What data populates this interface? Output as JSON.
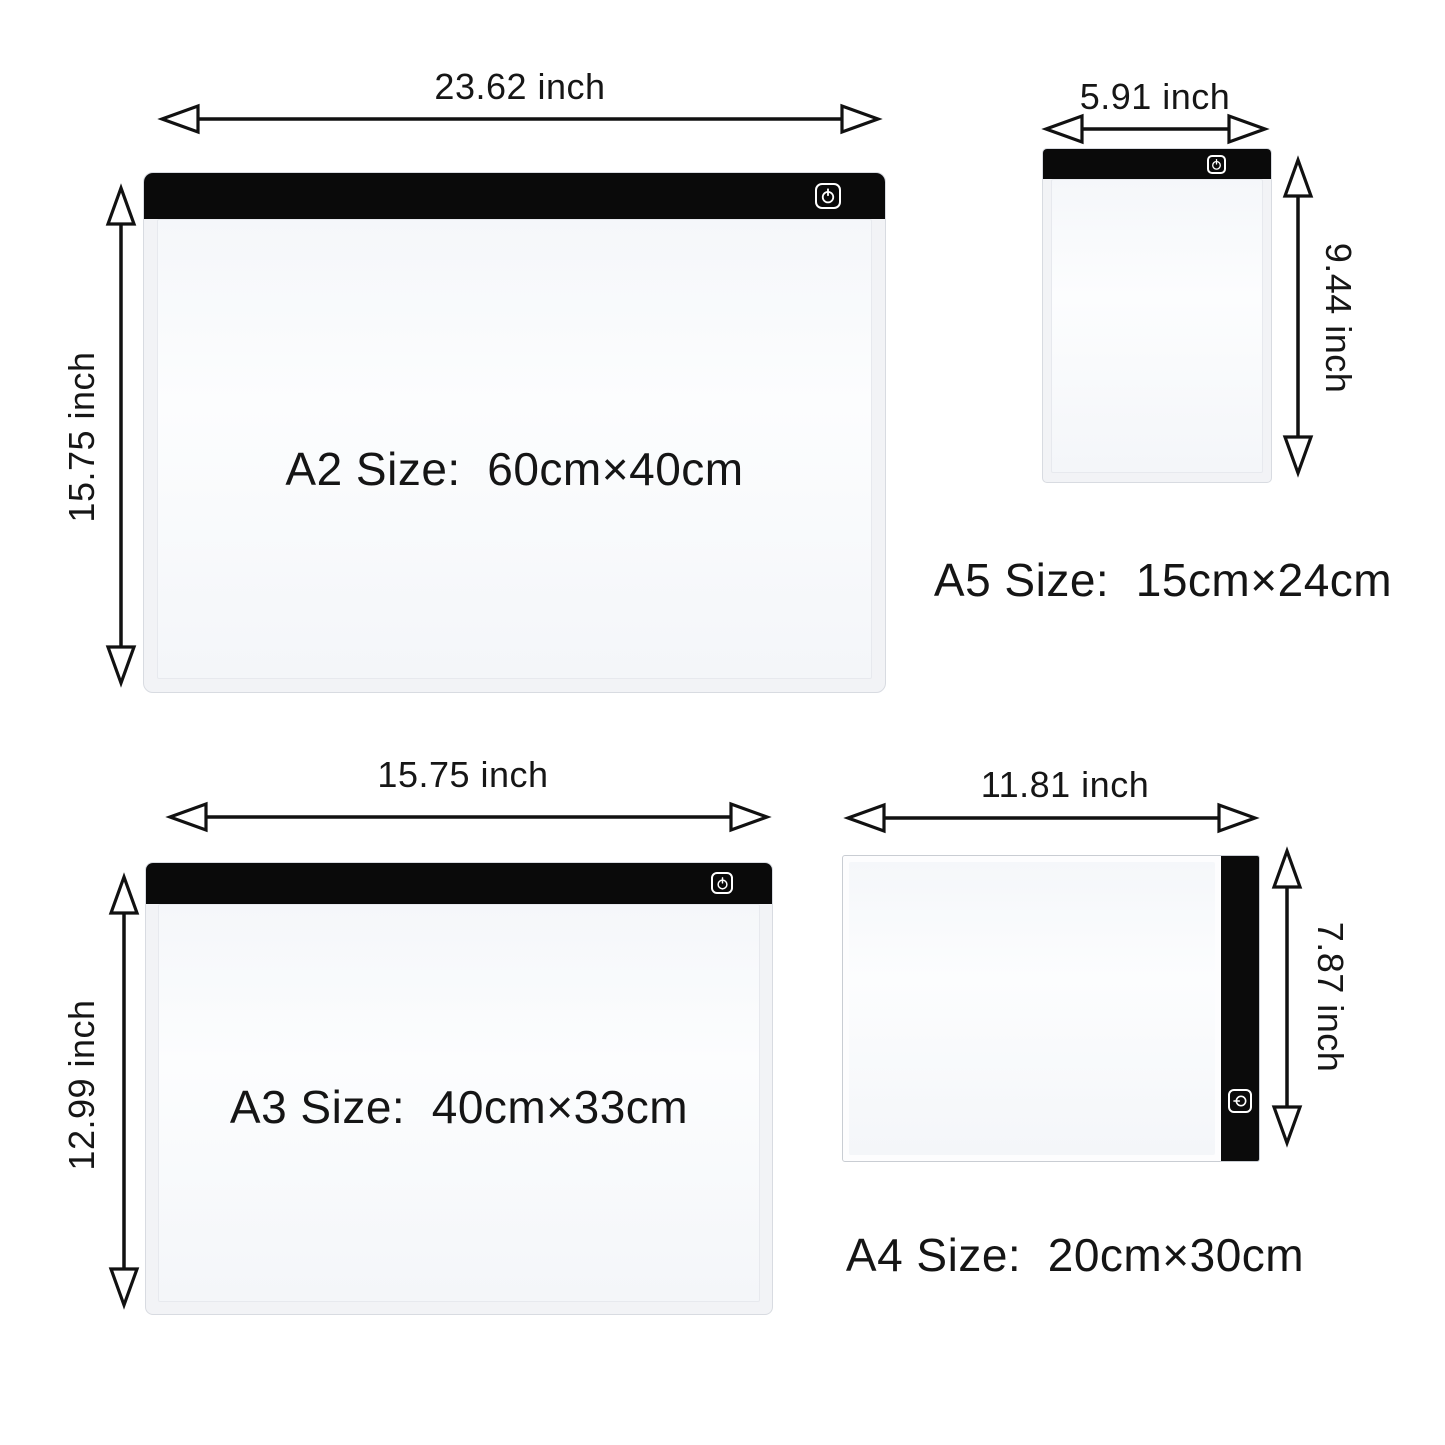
{
  "colors": {
    "background": "#ffffff",
    "pad_bar": "#0a0a0a",
    "arrow": "#111111",
    "text": "#1b1b1b"
  },
  "pads": {
    "a2": {
      "size_label": "A2 Size:  60cm×40cm",
      "width_inch": "23.62 inch",
      "height_inch": "15.75 inch",
      "power_icon": "power-icon"
    },
    "a5": {
      "size_label": "A5 Size:  15cm×24cm",
      "width_inch": "5.91 inch",
      "height_inch": "9.44 inch",
      "power_icon": "power-icon"
    },
    "a3": {
      "size_label": "A3 Size:  40cm×33cm",
      "width_inch": "15.75 inch",
      "height_inch": "12.99 inch",
      "power_icon": "power-icon"
    },
    "a4": {
      "size_label": "A4 Size:  20cm×30cm",
      "width_inch": "11.81 inch",
      "height_inch": "7.87 inch",
      "power_icon": "power-icon"
    }
  }
}
